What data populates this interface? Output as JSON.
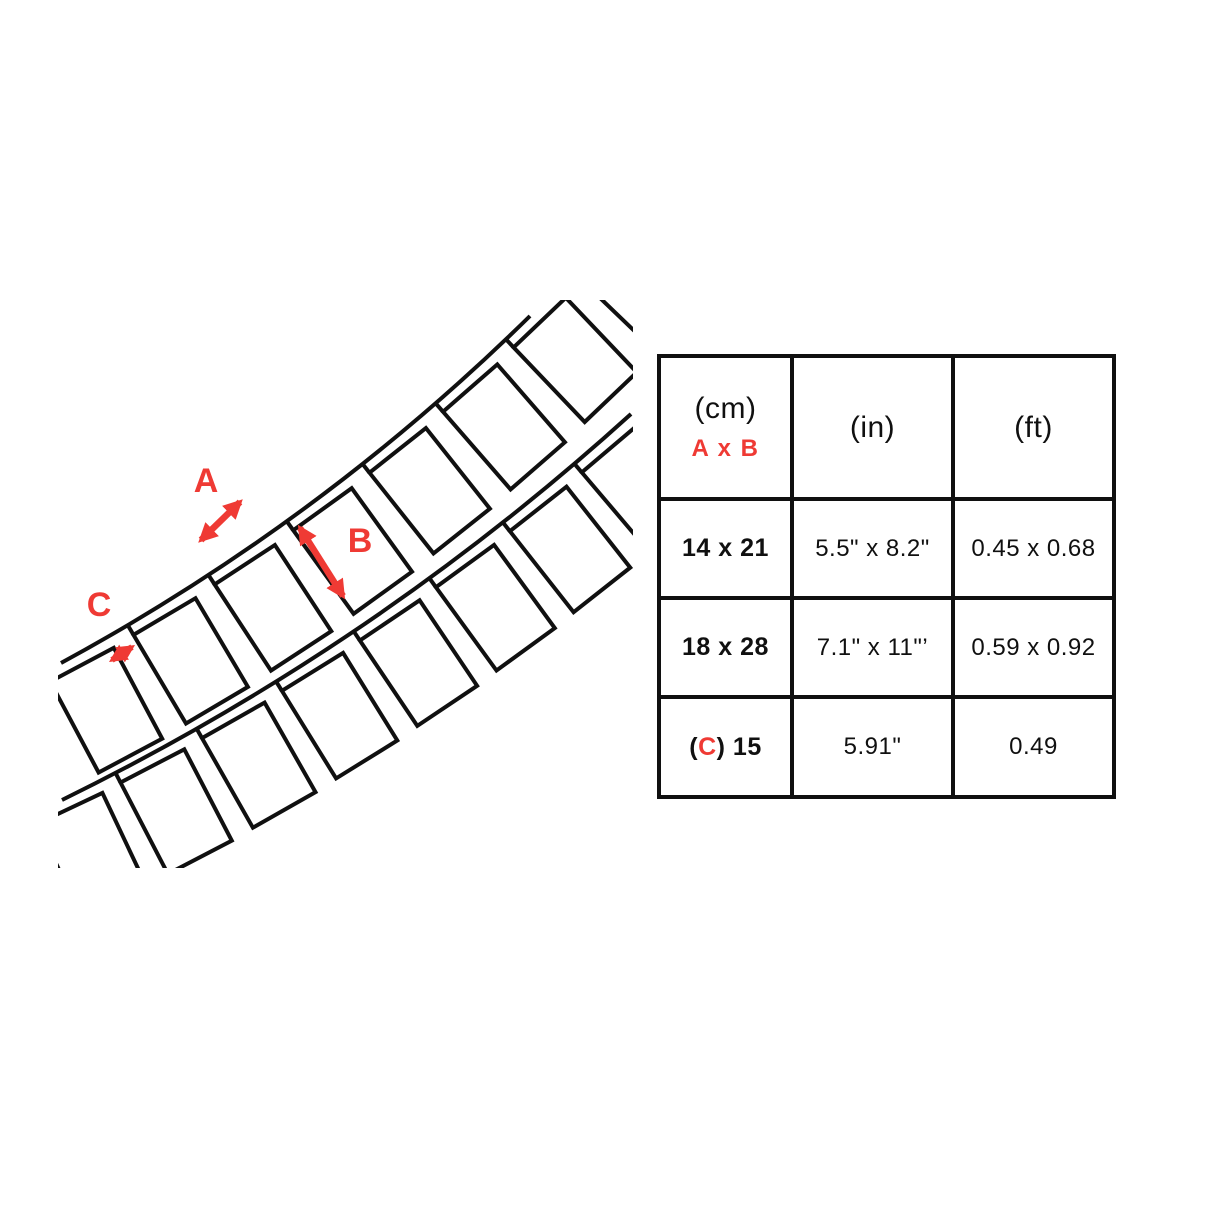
{
  "colors": {
    "red": "#ef3a34",
    "ink": "#101010",
    "background": "#ffffff"
  },
  "diagram": {
    "label_a": "A",
    "label_b": "B",
    "label_c": "C"
  },
  "table": {
    "header": {
      "cm_unit": "(cm)",
      "cm_dims": "A x B",
      "in_unit": "(in)",
      "ft_unit": "(ft)"
    },
    "rows": [
      {
        "cm": "14 x 21",
        "inch": "5.5\" x 8.2\"",
        "ft": "0.45 x 0.68"
      },
      {
        "cm": "18 x 28",
        "inch": "7.1\" x 11\"’",
        "ft": "0.59 x 0.92"
      },
      {
        "cm_open": "(",
        "cm_c": "C",
        "cm_close": ") 15",
        "inch": "5.91\"",
        "ft": "0.49"
      }
    ]
  }
}
